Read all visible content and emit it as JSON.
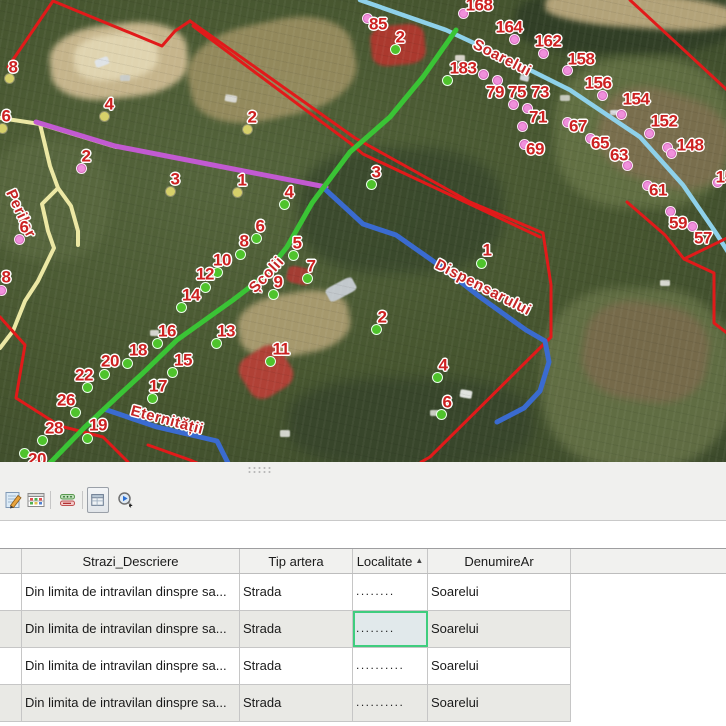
{
  "map": {
    "street_labels": [
      {
        "text": "Perilor",
        "x": 10,
        "y": 183,
        "rotate": 65
      },
      {
        "text": "Soarelui",
        "x": 474,
        "y": 36,
        "rotate": 27
      },
      {
        "text": "Școlii",
        "x": 252,
        "y": 283,
        "rotate": -47
      },
      {
        "text": "Dispensarului",
        "x": 436,
        "y": 256,
        "rotate": 27
      },
      {
        "text": "Eternității",
        "x": 131,
        "y": 403,
        "rotate": 15
      }
    ],
    "marker_colors": {
      "g": "#4fc32c",
      "p": "#f090dc",
      "y": "#d6d06a"
    },
    "label_color": "#cd2121",
    "markers": [
      {
        "n": "8",
        "c": "y",
        "d": [
          9,
          78
        ],
        "l": [
          13,
          67
        ]
      },
      {
        "n": "6",
        "c": "y",
        "d": [
          2,
          128
        ],
        "l": [
          6,
          116
        ]
      },
      {
        "n": "4",
        "c": "y",
        "d": [
          104,
          116
        ],
        "l": [
          109,
          104
        ]
      },
      {
        "n": "2",
        "c": "y",
        "d": [
          247,
          129
        ],
        "l": [
          252,
          117
        ]
      },
      {
        "n": "3",
        "c": "y",
        "d": [
          170,
          191
        ],
        "l": [
          175,
          179
        ]
      },
      {
        "n": "1",
        "c": "y",
        "d": [
          237,
          192
        ],
        "l": [
          242,
          180
        ]
      },
      {
        "n": "2",
        "c": "p",
        "d": [
          81,
          168
        ],
        "l": [
          86,
          156
        ]
      },
      {
        "n": "6",
        "c": "p",
        "d": [
          19,
          239
        ],
        "l": [
          24,
          227
        ]
      },
      {
        "n": "8",
        "c": "p",
        "d": [
          1,
          290
        ],
        "l": [
          6,
          277
        ]
      },
      {
        "n": "4",
        "c": "g",
        "d": [
          284,
          204
        ],
        "l": [
          289,
          192
        ]
      },
      {
        "n": "6",
        "c": "g",
        "d": [
          256,
          238
        ],
        "l": [
          260,
          226
        ]
      },
      {
        "n": "8",
        "c": "g",
        "d": [
          240,
          254
        ],
        "l": [
          244,
          241
        ]
      },
      {
        "n": "10",
        "c": "g",
        "d": [
          217,
          272
        ],
        "l": [
          222,
          260
        ]
      },
      {
        "n": "5",
        "c": "g",
        "d": [
          293,
          255
        ],
        "l": [
          297,
          243
        ]
      },
      {
        "n": "12",
        "c": "g",
        "d": [
          205,
          287
        ],
        "l": [
          205,
          274
        ]
      },
      {
        "n": "7",
        "c": "g",
        "d": [
          307,
          278
        ],
        "l": [
          311,
          266
        ]
      },
      {
        "n": "9",
        "c": "g",
        "d": [
          273,
          294
        ],
        "l": [
          278,
          282
        ]
      },
      {
        "n": "14",
        "c": "g",
        "d": [
          181,
          307
        ],
        "l": [
          191,
          295
        ]
      },
      {
        "n": "16",
        "c": "g",
        "d": [
          157,
          343
        ],
        "l": [
          167,
          331
        ]
      },
      {
        "n": "13",
        "c": "g",
        "d": [
          216,
          343
        ],
        "l": [
          226,
          331
        ]
      },
      {
        "n": "11",
        "c": "g",
        "d": [
          270,
          361
        ],
        "l": [
          281,
          349
        ]
      },
      {
        "n": "18",
        "c": "g",
        "d": [
          127,
          363
        ],
        "l": [
          138,
          350
        ]
      },
      {
        "n": "20",
        "c": "g",
        "d": [
          104,
          374
        ],
        "l": [
          110,
          361
        ]
      },
      {
        "n": "15",
        "c": "g",
        "d": [
          172,
          372
        ],
        "l": [
          183,
          360
        ]
      },
      {
        "n": "22",
        "c": "g",
        "d": [
          87,
          387
        ],
        "l": [
          84,
          375
        ]
      },
      {
        "n": "17",
        "c": "g",
        "d": [
          152,
          398
        ],
        "l": [
          158,
          386
        ]
      },
      {
        "n": "26",
        "c": "g",
        "d": [
          75,
          412
        ],
        "l": [
          66,
          400
        ]
      },
      {
        "n": "28",
        "c": "g",
        "d": [
          42,
          440
        ],
        "l": [
          54,
          428
        ]
      },
      {
        "n": "19",
        "c": "g",
        "d": [
          87,
          438
        ],
        "l": [
          98,
          425
        ]
      },
      {
        "n": "20",
        "c": "g",
        "d": [
          24,
          453
        ],
        "l": [
          37,
          459
        ]
      },
      {
        "n": "2",
        "c": "g",
        "d": [
          395,
          49
        ],
        "l": [
          400,
          37
        ]
      },
      {
        "n": "3",
        "c": "g",
        "d": [
          371,
          184
        ],
        "l": [
          376,
          172
        ]
      },
      {
        "n": "1",
        "c": "g",
        "d": [
          481,
          263
        ],
        "l": [
          487,
          250
        ]
      },
      {
        "n": "2",
        "c": "g",
        "d": [
          376,
          329
        ],
        "l": [
          382,
          317
        ]
      },
      {
        "n": "4",
        "c": "g",
        "d": [
          437,
          377
        ],
        "l": [
          443,
          365
        ]
      },
      {
        "n": "6",
        "c": "g",
        "d": [
          441,
          414
        ],
        "l": [
          447,
          402
        ]
      },
      {
        "n": "",
        "c": "g",
        "d": [
          447,
          80
        ],
        "l": null
      },
      {
        "n": "168",
        "c": "p",
        "d": [
          463,
          13
        ],
        "l": [
          479,
          5
        ]
      },
      {
        "n": "85",
        "c": "p",
        "d": [
          367,
          18
        ],
        "l": [
          378,
          24
        ]
      },
      {
        "n": "164",
        "c": "p",
        "d": [
          514,
          39
        ],
        "l": [
          509,
          27
        ]
      },
      {
        "n": "162",
        "c": "p",
        "d": [
          543,
          53
        ],
        "l": [
          548,
          41
        ]
      },
      {
        "n": "158",
        "c": "p",
        "d": [
          567,
          70
        ],
        "l": [
          581,
          59
        ]
      },
      {
        "n": "183",
        "c": "p",
        "d": [
          483,
          74
        ],
        "l": [
          463,
          68
        ]
      },
      {
        "n": "156",
        "c": "p",
        "d": [
          602,
          95
        ],
        "l": [
          598,
          83
        ]
      },
      {
        "n": "79",
        "c": "p",
        "d": [
          497,
          80
        ],
        "l": [
          495,
          92
        ]
      },
      {
        "n": "75",
        "c": "p",
        "d": [
          513,
          104
        ],
        "l": [
          517,
          92
        ]
      },
      {
        "n": "73",
        "c": "p",
        "d": [
          527,
          108
        ],
        "l": [
          540,
          92
        ]
      },
      {
        "n": "71",
        "c": "p",
        "d": [
          522,
          126
        ],
        "l": [
          538,
          117
        ]
      },
      {
        "n": "154",
        "c": "p",
        "d": [
          621,
          114
        ],
        "l": [
          636,
          99
        ]
      },
      {
        "n": "152",
        "c": "p",
        "d": [
          649,
          133
        ],
        "l": [
          664,
          121
        ]
      },
      {
        "n": "67",
        "c": "p",
        "d": [
          567,
          122
        ],
        "l": [
          578,
          126
        ]
      },
      {
        "n": "65",
        "c": "p",
        "d": [
          590,
          138
        ],
        "l": [
          600,
          143
        ]
      },
      {
        "n": "63",
        "c": "p",
        "d": [
          627,
          165
        ],
        "l": [
          619,
          155
        ]
      },
      {
        "n": "69",
        "c": "p",
        "d": [
          524,
          144
        ],
        "l": [
          535,
          149
        ]
      },
      {
        "n": "148",
        "c": "p",
        "d": [
          667,
          147
        ],
        "l": [
          690,
          145
        ]
      },
      {
        "n": "",
        "c": "p",
        "d": [
          671,
          153
        ],
        "l": null
      },
      {
        "n": "61",
        "c": "p",
        "d": [
          647,
          185
        ],
        "l": [
          658,
          190
        ]
      },
      {
        "n": "59",
        "c": "p",
        "d": [
          670,
          211
        ],
        "l": [
          678,
          223
        ]
      },
      {
        "n": "57",
        "c": "p",
        "d": [
          692,
          226
        ],
        "l": [
          703,
          238
        ]
      },
      {
        "n": "150",
        "c": "p",
        "d": [
          717,
          182
        ],
        "l": [
          729,
          177
        ]
      }
    ],
    "lines": [
      {
        "name": "road-perilor-west",
        "color": "#ece8a4",
        "width": 4,
        "path": "M0,118 L40,124 L116,147"
      },
      {
        "name": "road-perilor",
        "color": "#ece8a4",
        "width": 4,
        "path": "M40,124 L50,166 L58,188 L71,206 L78,231 L78,245"
      },
      {
        "name": "road-perilor-branch",
        "color": "#ece8a4",
        "width": 4,
        "path": "M58,188 L42,204 L48,231 L54,248 L38,281 L25,301 L13,331 L0,348"
      },
      {
        "name": "road-soarelui",
        "color": "#8ed1ea",
        "width": 4.5,
        "path": "M360,0 L446,30 L506,58 L570,90 L640,137 L683,185 L716,233 L728,252"
      },
      {
        "name": "boundary-1",
        "color": "#e11a1a",
        "width": 3,
        "path": "M53,1 L8,67"
      },
      {
        "name": "boundary-2",
        "color": "#e11a1a",
        "width": 3,
        "path": "M53,1 L162,46 L175,31 L190,21"
      },
      {
        "name": "boundary-3",
        "color": "#e11a1a",
        "width": 3,
        "path": "M190,21 L355,138 L470,202 L543,233"
      },
      {
        "name": "boundary-4",
        "color": "#e11a1a",
        "width": 3,
        "path": "M193,26 L350,143 L363,154 L540,237"
      },
      {
        "name": "boundary-5",
        "color": "#e11a1a",
        "width": 3,
        "path": "M543,233 L551,285 L551,337 L430,457 L421,462"
      },
      {
        "name": "boundary-6",
        "color": "#e11a1a",
        "width": 3,
        "path": "M630,0 L726,89"
      },
      {
        "name": "boundary-7",
        "color": "#e11a1a",
        "width": 3,
        "path": "M627,202 L665,235 L684,259 L714,273 L714,323 L727,333"
      },
      {
        "name": "boundary-8",
        "color": "#e11a1a",
        "width": 3,
        "path": "M727,238 L684,259"
      },
      {
        "name": "boundary-9",
        "color": "#e11a1a",
        "width": 3,
        "path": "M0,317 L25,345 L16,398 L60,426 L103,437 L128,462"
      },
      {
        "name": "boundary-10",
        "color": "#e11a1a",
        "width": 3,
        "path": "M148,445 L190,460 L197,463"
      },
      {
        "name": "street-artera-violet",
        "color": "#c25ad1",
        "width": 5,
        "path": "M36,122 L115,146 L326,187"
      },
      {
        "name": "street-dispensarului",
        "color": "#3a6bd0",
        "width": 5,
        "path": "M326,190 L363,224 L396,235 L443,268 L480,297 L526,330 L545,341 L549,362 L540,391 L524,408 L497,422"
      },
      {
        "name": "street-eternitatii",
        "color": "#3a6bd0",
        "width": 5,
        "path": "M104,409 L157,427 L217,441 L228,463"
      },
      {
        "name": "street-scolii",
        "color": "#3ac435",
        "width": 5,
        "path": "M456,30 L423,77 L390,117 L350,152 L312,203 L287,247 L263,277 L233,300 L177,340 L143,373 L117,397 L85,427 L50,463"
      }
    ]
  },
  "toolbar": {
    "icons": [
      {
        "name": "edit-attributes"
      },
      {
        "name": "open-attribute-table"
      },
      {
        "name": "switch-selection"
      },
      {
        "name": "show-table-window",
        "selected": true
      },
      {
        "name": "zoom-to-selected"
      }
    ]
  },
  "table": {
    "columns": {
      "rowsel": "",
      "descriere": "Strazi_Descriere",
      "tip": "Tip artera",
      "localitate": "Localitate",
      "denumire": "DenumireAr"
    },
    "sort_indicator": "▲",
    "sorted_column": "localitate",
    "selected_cell": {
      "row": 1,
      "column": "localitate"
    },
    "rows": [
      {
        "descriere": "Din limita de intravilan dinspre sa...",
        "tip": "Strada",
        "localitate": "........",
        "denumire": "Soarelui"
      },
      {
        "descriere": "Din limita de intravilan dinspre sa...",
        "tip": "Strada",
        "localitate": "........",
        "denumire": "Soarelui"
      },
      {
        "descriere": "Din limita de intravilan dinspre sa...",
        "tip": "Strada",
        "localitate": "..........",
        "denumire": "Soarelui"
      },
      {
        "descriere": "Din limita de intravilan dinspre sa...",
        "tip": "Strada",
        "localitate": "..........",
        "denumire": "Soarelui"
      }
    ]
  }
}
